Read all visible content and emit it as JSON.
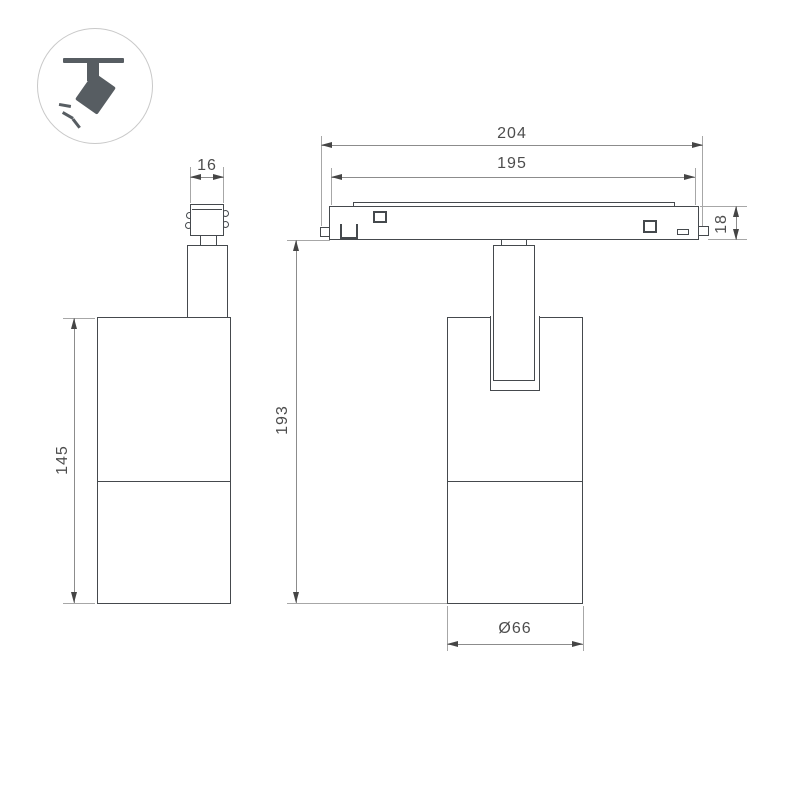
{
  "icon": {
    "name": "ceiling-track-spotlight-icon"
  },
  "side_view": {
    "adapter_width_label": "16",
    "body_height_label": "145"
  },
  "front_view": {
    "overall_width_label": "204",
    "inner_width_label": "195",
    "track_height_label": "18",
    "overall_height_label": "193",
    "diameter_label": "Ø66"
  },
  "colors": {
    "background": "#ffffff",
    "outline": "#45494d",
    "dimension_line": "#8c8c8c",
    "extension_line": "#a7a7a7",
    "arrow": "#454545",
    "text": "#4d4d4d",
    "icon_fill": "#575d62",
    "icon_ring": "#c9c9c9"
  }
}
